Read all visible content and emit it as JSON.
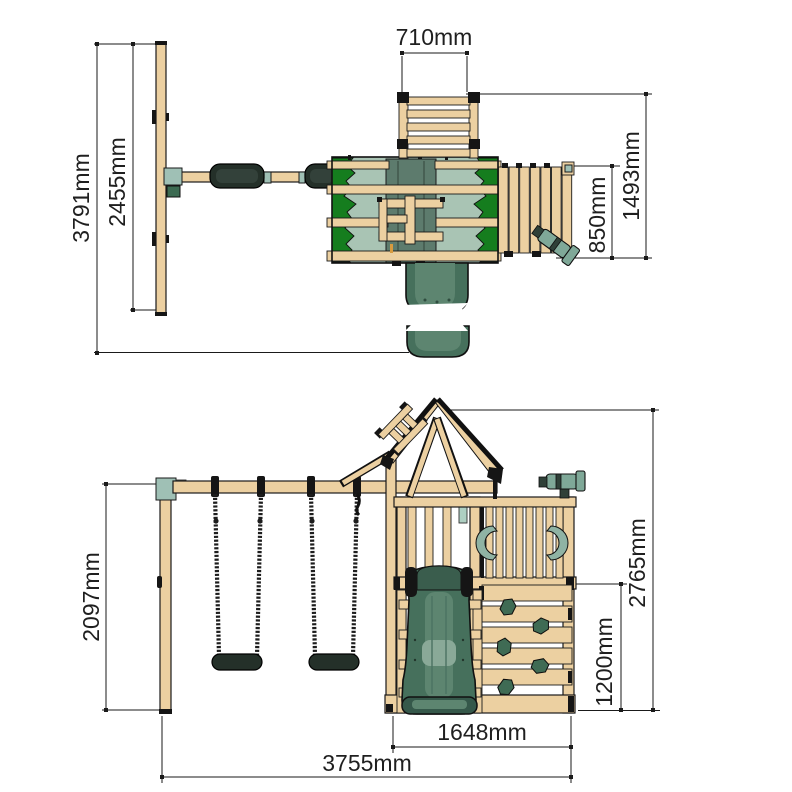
{
  "diagram_title": "wooden climbing frame with swings - dimension drawing, plan view (top) and front elevation (bottom)",
  "colors": {
    "background": "#ffffff",
    "wood": "#ecd0a1",
    "outline": "#1a1a1a",
    "canopy_green": "#157d1e",
    "canopy_sage": "#a9c4b4",
    "canopy_center": "#5d7b6d",
    "bracket_teal": "#9fc0b5",
    "slide_green": "#46705c",
    "slide_inner": "#5d8570",
    "seat_black": "#243029",
    "hold_green": "#3f6b54",
    "telescope": "#7fa898"
  },
  "top_view": {
    "overall_depth": "3791mm",
    "swing_frame_depth": "2455mm",
    "ladder_width": "710mm",
    "platform_side_depth": "1493mm",
    "deck_depth": "850mm"
  },
  "front_view": {
    "swing_frame_height": "2097mm",
    "overall_height": "2765mm",
    "climbing_wall_height": "1200mm",
    "tower_width": "1648mm",
    "overall_width": "3755mm"
  }
}
